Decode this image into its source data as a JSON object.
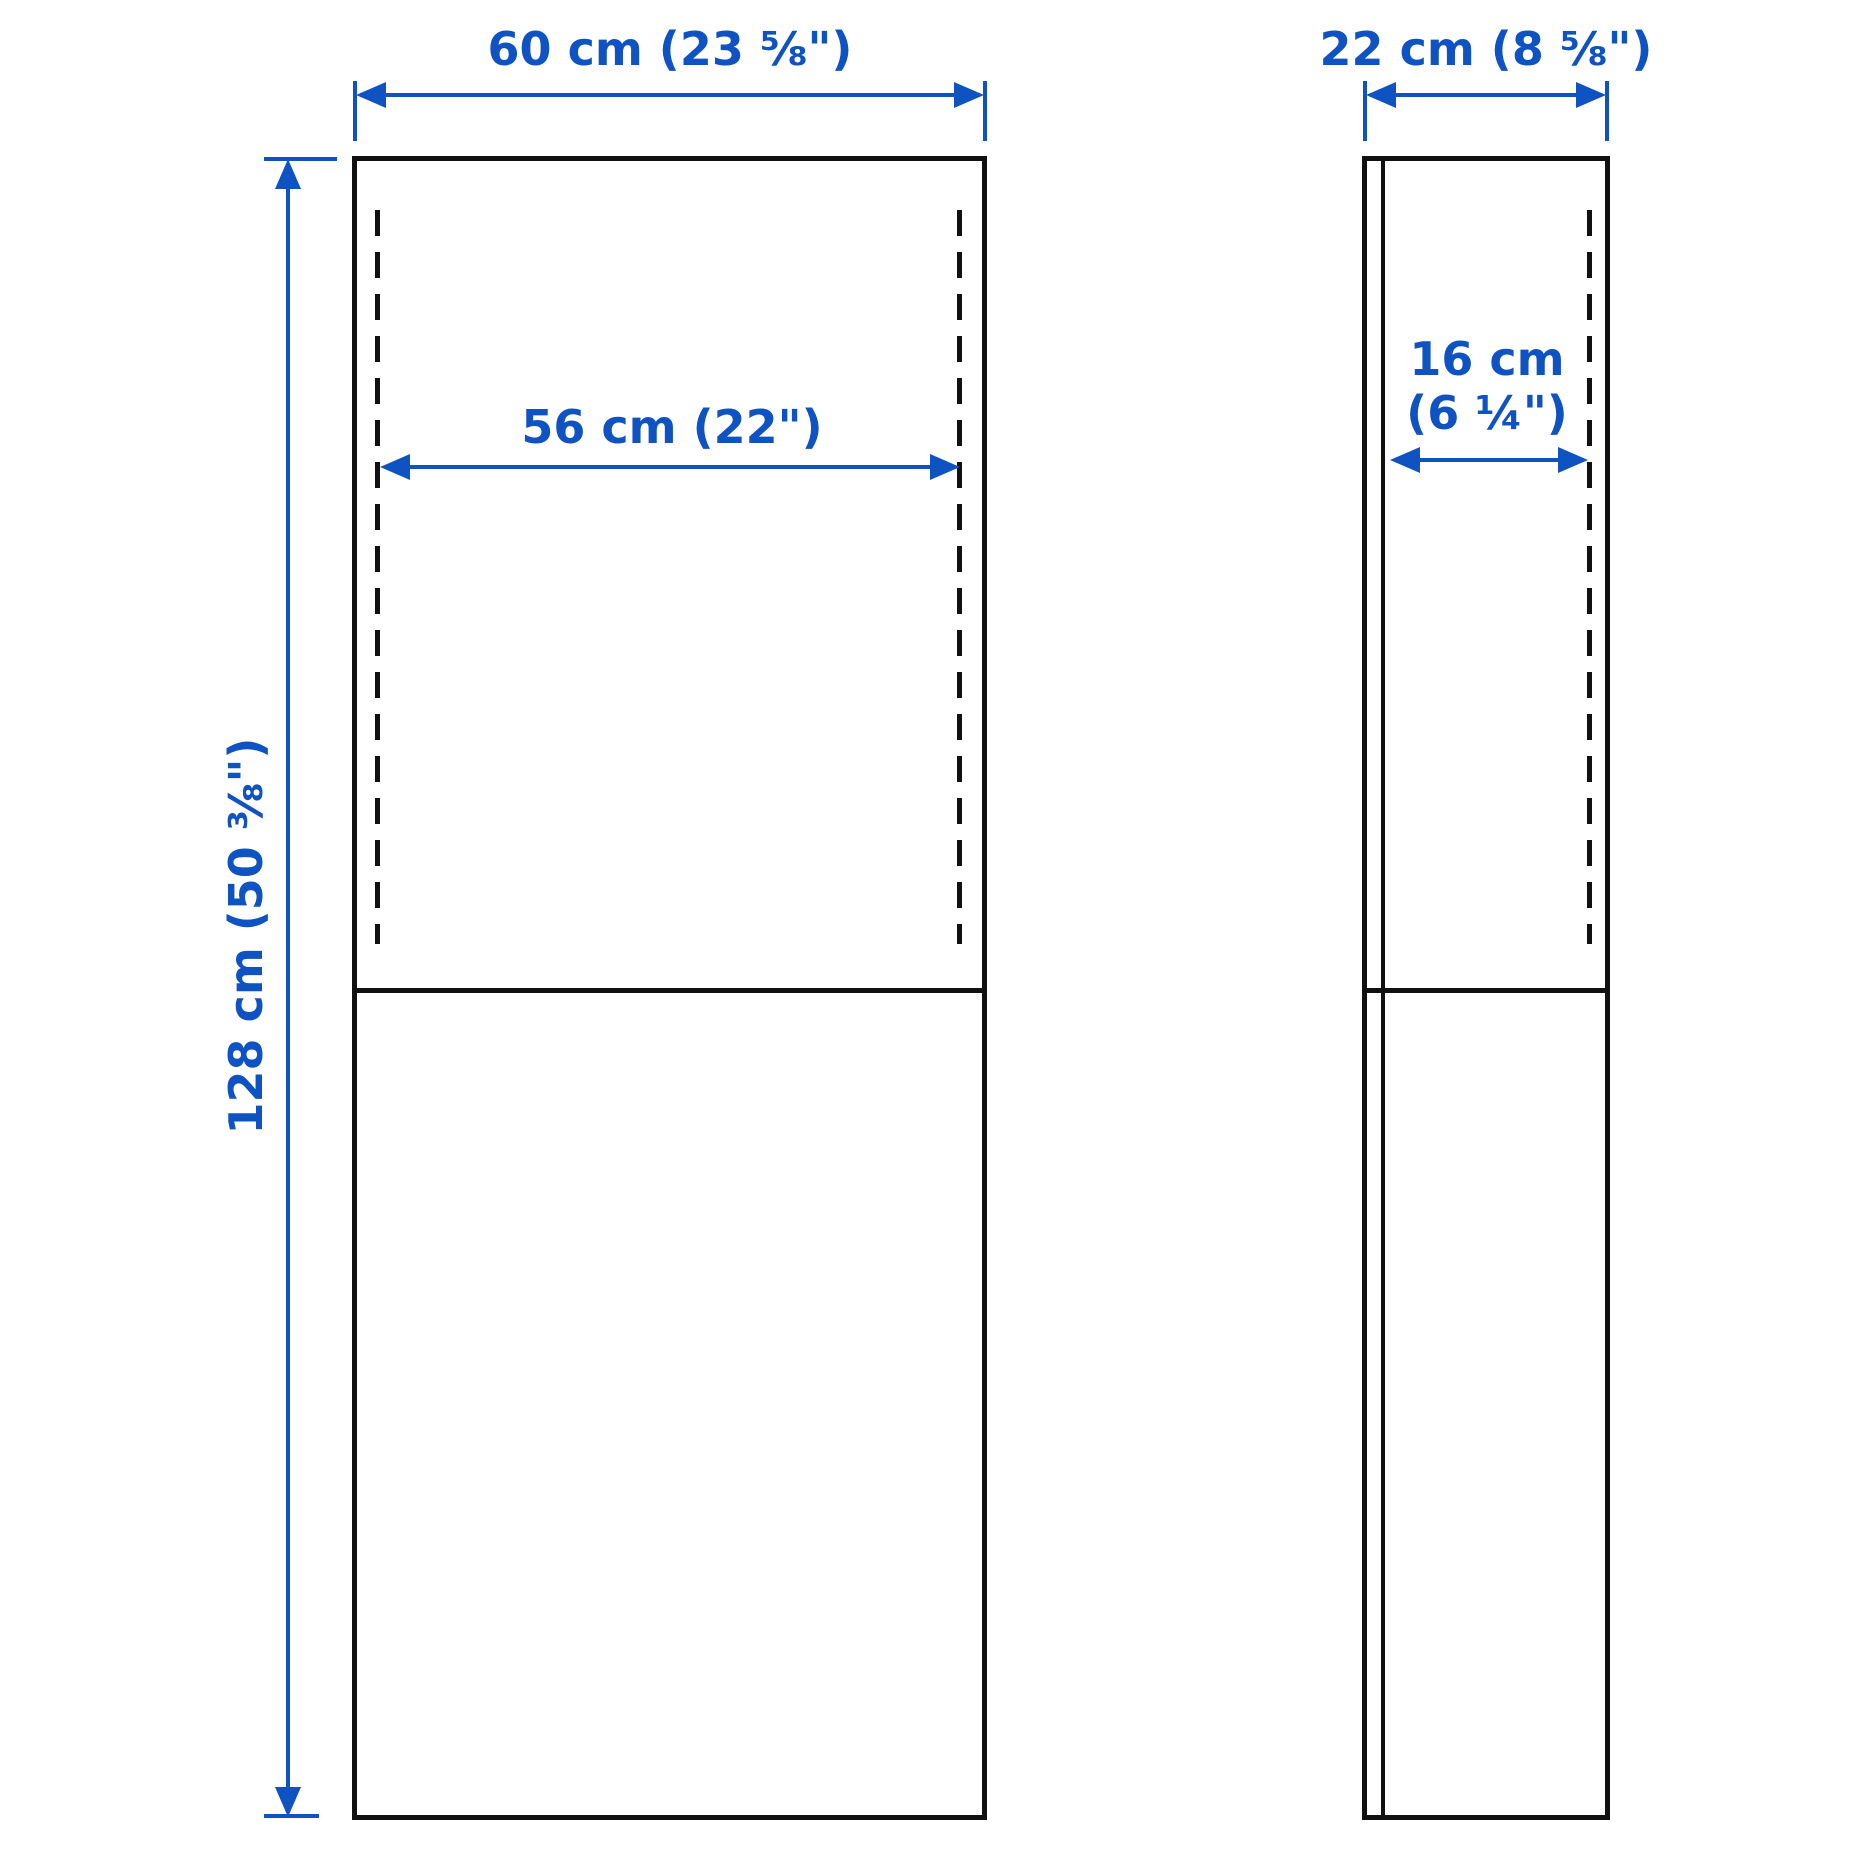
{
  "diagram": {
    "front_view": {
      "overall_width_label": "60 cm (23 ⅝\")",
      "overall_height_label": "128 cm (50 ⅜\")",
      "interior_width_label": "56 cm (22\")"
    },
    "side_view": {
      "overall_depth_label": "22 cm (8 ⅝\")",
      "interior_depth_label_line1": "16 cm",
      "interior_depth_label_line2": "(6 ¼\")"
    }
  },
  "colors": {
    "dimension_blue": "#0f53c2",
    "outline_black": "#111111",
    "background": "#ffffff"
  }
}
